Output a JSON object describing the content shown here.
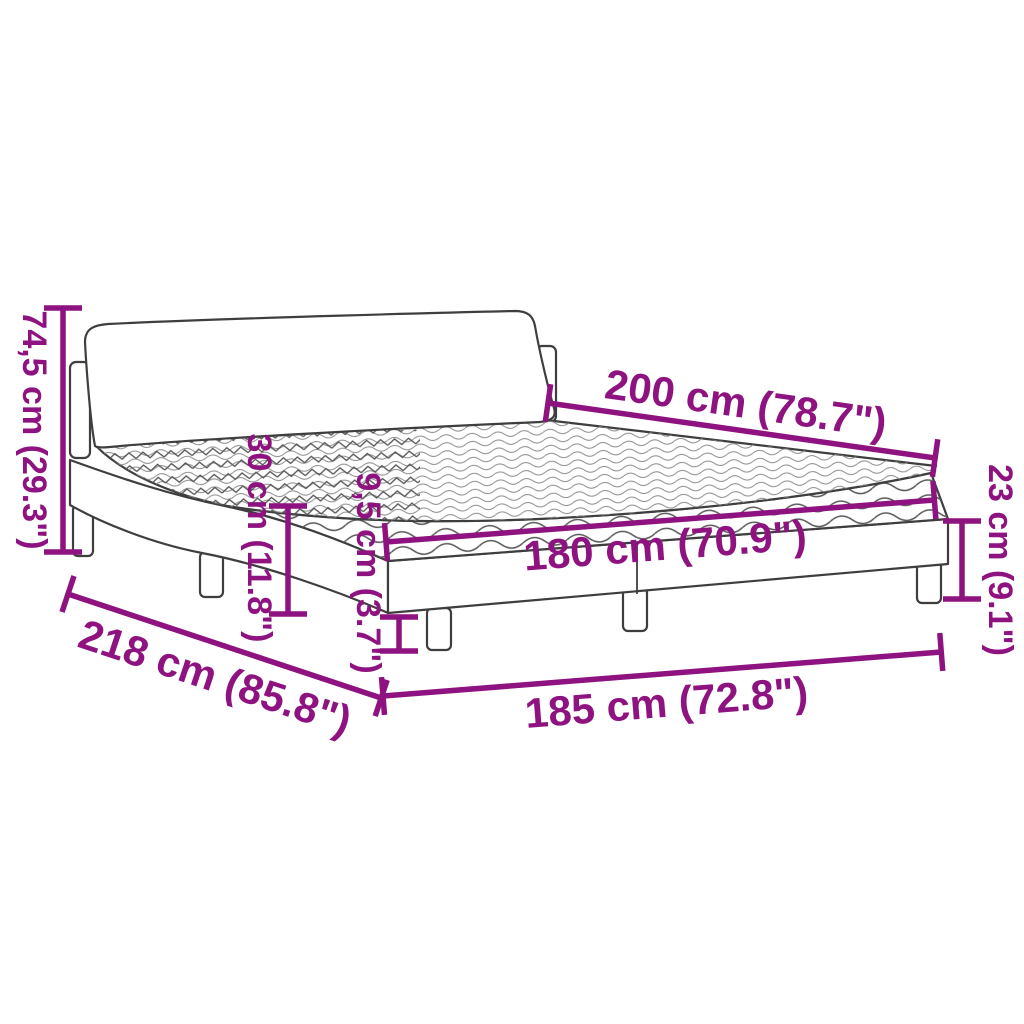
{
  "page": {
    "background": "#FFFFFF"
  },
  "diagram": {
    "subject": "upholstered-bed-with-mattress",
    "accent_color": "#8E1280",
    "outline_color": "#3E3E3E",
    "measurements": [
      {
        "id": "total-height",
        "label": "74,5 cm (29.3\")"
      },
      {
        "id": "bed-length",
        "label": "200 cm (78.7\")"
      },
      {
        "id": "frame-height",
        "label": "23 cm (9.1\")"
      },
      {
        "id": "side-height",
        "label": "30 cm (11.8\")"
      },
      {
        "id": "rail-height",
        "label": "9,5 cm (3.7\")"
      },
      {
        "id": "mattress-width",
        "label": "180 cm (70.9\")"
      },
      {
        "id": "total-length",
        "label": "218 cm (85.8\")"
      },
      {
        "id": "frame-width",
        "label": "185 cm (72.8\")"
      }
    ]
  }
}
